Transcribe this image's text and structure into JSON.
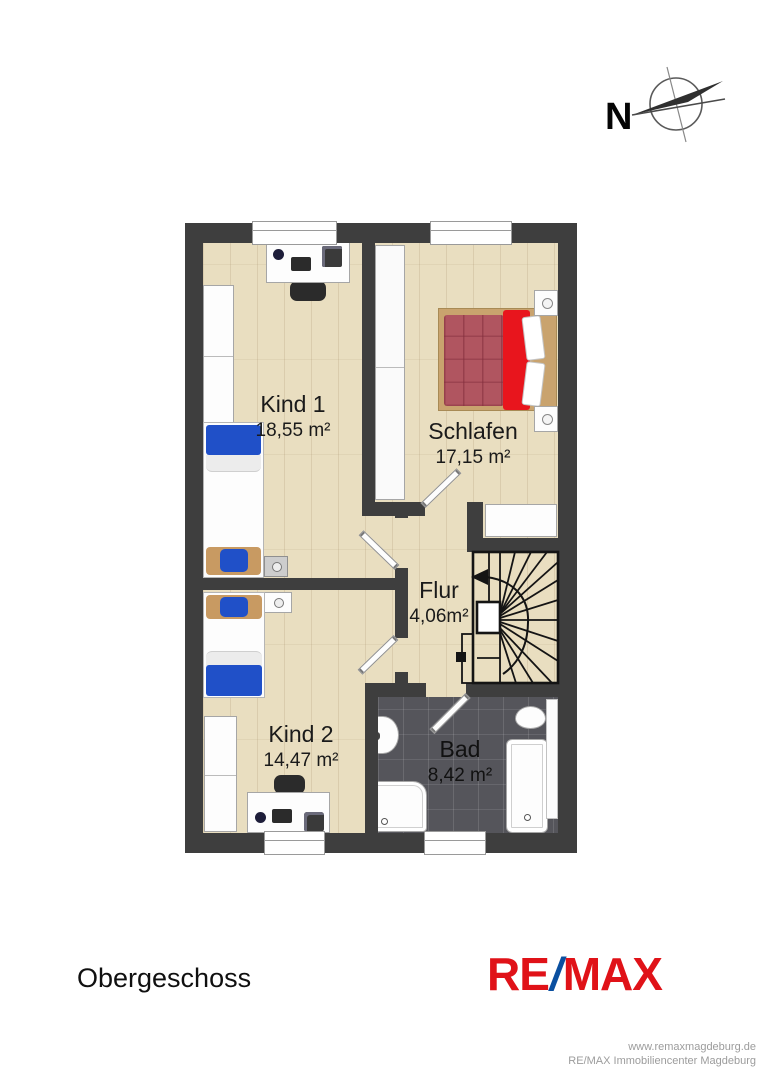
{
  "compass": {
    "north_label": "N"
  },
  "rooms": [
    {
      "key": "kind1",
      "name": "Kind 1",
      "area": "18,55 m²"
    },
    {
      "key": "schlafen",
      "name": "Schlafen",
      "area": "17,15 m²"
    },
    {
      "key": "flur",
      "name": "Flur",
      "area": "4,06m²"
    },
    {
      "key": "kind2",
      "name": "Kind 2",
      "area": "14,47 m²"
    },
    {
      "key": "bad",
      "name": "Bad",
      "area": "8,42 m²"
    }
  ],
  "footer": {
    "floor_label": "Obergeschoss",
    "logo": {
      "part1": "RE",
      "slash": "/",
      "part2": "MAX"
    },
    "website": "www.remaxmagdeburg.de",
    "company": "RE/MAX Immobiliencenter Magdeburg"
  },
  "colors": {
    "wall": "#3e3e3e",
    "floor_wood": "#e9dec0",
    "bathroom_tile": "#55555b",
    "bed_blue": "#2050c8",
    "bed_red": "#e8151d",
    "quilt_maroon": "#b05560",
    "wood_tan": "#c89a62",
    "logo_red": "#e01218",
    "logo_blue": "#0a4fa0"
  }
}
